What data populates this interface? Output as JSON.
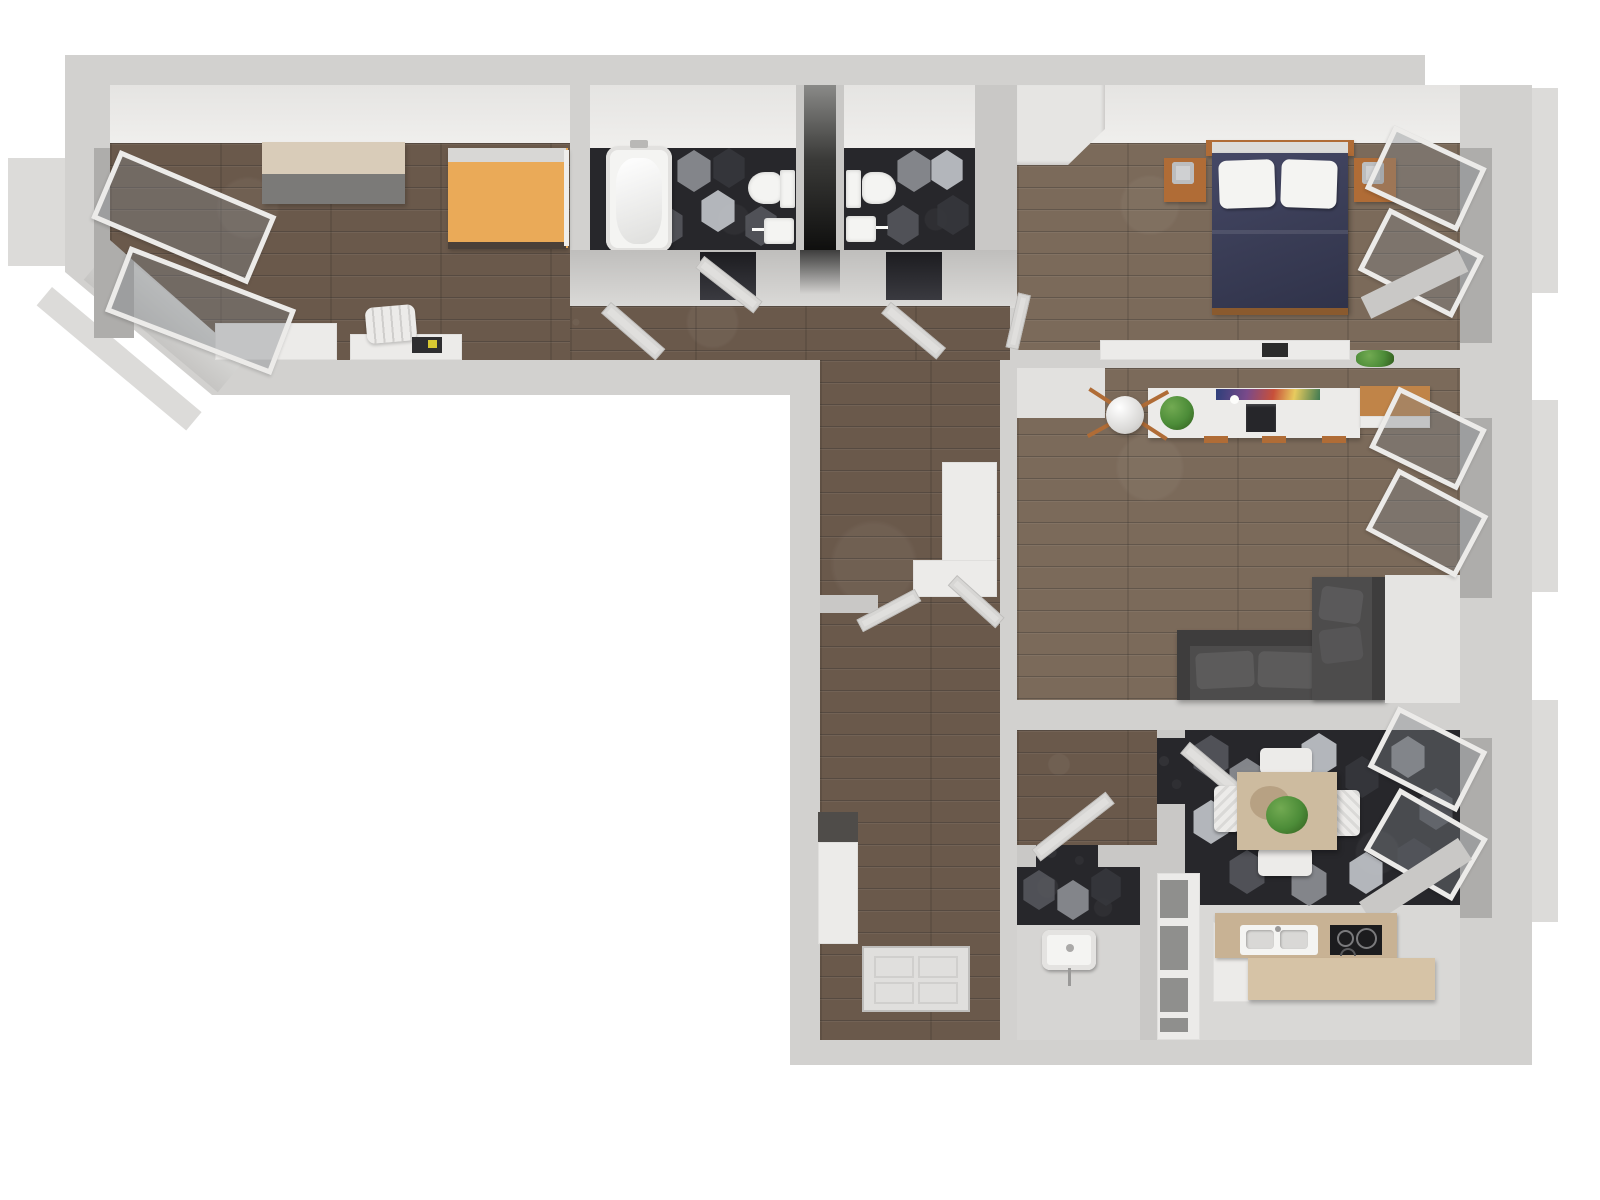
{
  "scene": {
    "kind": "3d-rendered-floor-plan",
    "view": "top-down",
    "description": "L-shaped apartment 3D floor plan render on white background, no text labels"
  },
  "palette": {
    "bg": "#ffffff",
    "wall_outer": "#d2d1cf",
    "wall": "#c9c8c6",
    "wall_face": "#e5e4e2",
    "wall_sill": "#dcdbd9",
    "recess": "#aeadab",
    "floor_wood": "#6a594b",
    "floor_wood_light": "#7b6a5a",
    "tile": "#27272b",
    "hex_a": "#55575c",
    "hex_b": "#8e9095",
    "hex_c": "#36373c",
    "hex_d": "#c3c6cb",
    "white_furn": "#ecebe9",
    "fixture": "#f4f4f2",
    "door": "#e0dfdd",
    "door_edge": "#bfbebc",
    "bed_orange": "#eaaa58",
    "pillow": "#d8d7d5",
    "navy": "#3a3d56",
    "navy_dark": "#2f3249",
    "wood_accent": "#b06c36",
    "sofa": "#4d4c4c",
    "sofa_dark": "#3e3d3d",
    "sofa_light": "#5c5b5b",
    "table_tan": "#cdbb9f",
    "counter_tan": "#c8b294",
    "counter_tan_light": "#d6c3a6",
    "plant": "#4c8c38",
    "cooktop": "#1c1c1e",
    "shaft_dark": "#0f0f0e"
  },
  "rooms": [
    {
      "id": "bedroom-office",
      "floor": "dark-wood",
      "items": [
        "sideboard",
        "orange-single-bed",
        "desk",
        "desk-chair",
        "laptop",
        "built-in-counter",
        "open-casement-window",
        "open-casement-window"
      ]
    },
    {
      "id": "bathroom",
      "floor": "dark-hex-tile",
      "items": [
        "bathtub",
        "toilet",
        "washbasin",
        "open-door"
      ]
    },
    {
      "id": "light-shaft",
      "floor": "none",
      "items": []
    },
    {
      "id": "wc",
      "floor": "dark-hex-tile",
      "items": [
        "toilet",
        "washbasin",
        "open-door"
      ]
    },
    {
      "id": "bedroom",
      "floor": "wood",
      "items": [
        "double-bed-navy",
        "nightstand",
        "nightstand",
        "table-lamp",
        "table-lamp",
        "wardrobe",
        "wall-shelf",
        "camera",
        "open-casement-window",
        "open-casement-window",
        "ajar-door"
      ]
    },
    {
      "id": "living-room",
      "floor": "wood",
      "items": [
        "corner-sofa",
        "console-desk",
        "monitor",
        "artwork",
        "floor-lamp",
        "potted-plant",
        "wood-sideboard",
        "open-casement-window",
        "open-casement-window"
      ]
    },
    {
      "id": "kitchen-dining",
      "floor": "dark-hex-tile",
      "items": [
        "dining-table",
        "potted-plant",
        "chair",
        "chair",
        "chair",
        "chair",
        "kitchen-counter",
        "double-sink",
        "cooktop",
        "tall-cabinet",
        "island-counter",
        "shelf-unit",
        "open-door",
        "open-casement-window",
        "open-casement-window"
      ]
    },
    {
      "id": "small-bathroom",
      "floor": "dark-hex-tile",
      "items": [
        "washbasin",
        "open-door"
      ]
    },
    {
      "id": "hallway",
      "floor": "dark-wood",
      "items": [
        "hall-cabinet",
        "wardrobe",
        "dark-locker",
        "entry-door",
        "open-door",
        "open-door",
        "open-door"
      ]
    }
  ]
}
